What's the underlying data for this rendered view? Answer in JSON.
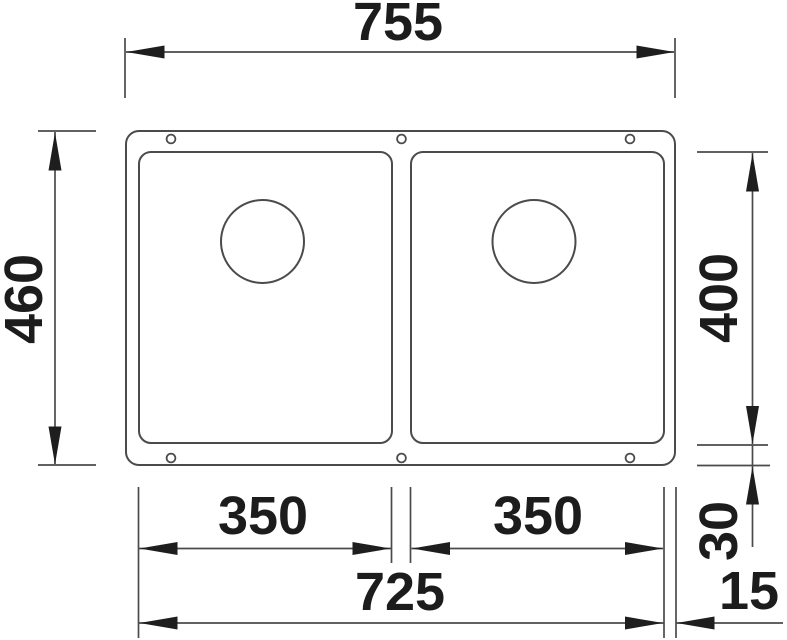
{
  "figure": {
    "type": "technical-dimension-drawing",
    "subject": "double-bowl undermount sink, plan view",
    "background_color": "#ffffff",
    "line_color": "#4b4b4b",
    "arrow_color": "#1e1e1e",
    "text_color": "#1c1c1c"
  },
  "dimensions": {
    "overall_width": "755",
    "overall_depth": "460",
    "bowl_depth": "400",
    "bowl_width_left": "350",
    "bowl_width_right": "350",
    "span_width": "725",
    "rim_offset": "30",
    "edge_offset": "15"
  }
}
